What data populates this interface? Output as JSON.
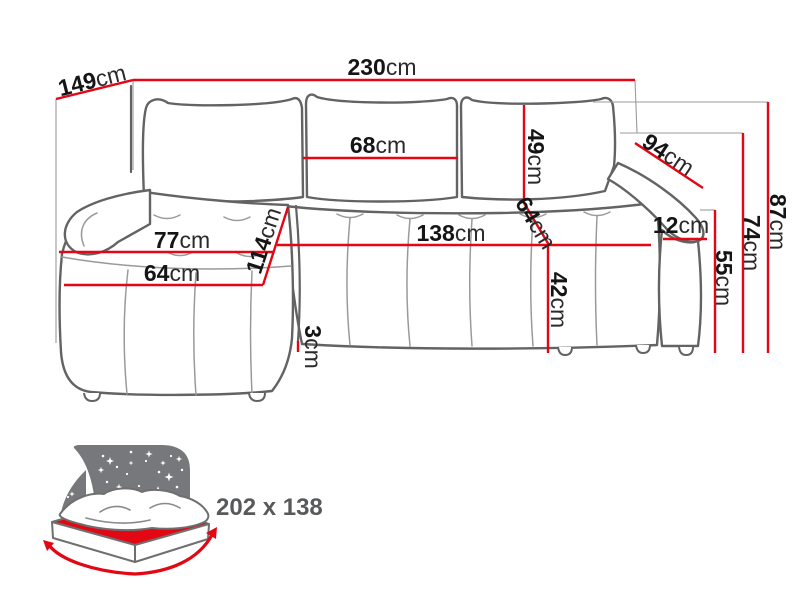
{
  "diagram_title": "corner sofa-bed dimension diagram",
  "dims": {
    "total_width": {
      "v": "230",
      "u": "cm"
    },
    "side_depth": {
      "v": "149",
      "u": "cm"
    },
    "cushion_width": {
      "v": "68",
      "u": "cm"
    },
    "backrest_height": {
      "v": "49",
      "u": "cm"
    },
    "seat_diagonal": {
      "v": "64",
      "u": "cm"
    },
    "armrest_length": {
      "v": "94",
      "u": "cm"
    },
    "armrest_width": {
      "v": "12",
      "u": "cm"
    },
    "total_height": {
      "v": "87",
      "u": "cm"
    },
    "frame_height": {
      "v": "74",
      "u": "cm"
    },
    "armrest_height": {
      "v": "55",
      "u": "cm"
    },
    "seat_width": {
      "v": "138",
      "u": "cm"
    },
    "seat_height": {
      "v": "42",
      "u": "cm"
    },
    "chaise_seat_width": {
      "v": "77",
      "u": "cm"
    },
    "chaise_cushion": {
      "v": "64",
      "u": "cm"
    },
    "chaise_length": {
      "v": "114",
      "u": "cm"
    },
    "base_gap": {
      "v": "3",
      "u": "cm"
    }
  },
  "sleeping_area": {
    "size_label": "202 x 138"
  },
  "colors": {
    "dimension_red": "#e30613",
    "icon_gray": "#77787b",
    "size_text_gray": "#58595b"
  }
}
